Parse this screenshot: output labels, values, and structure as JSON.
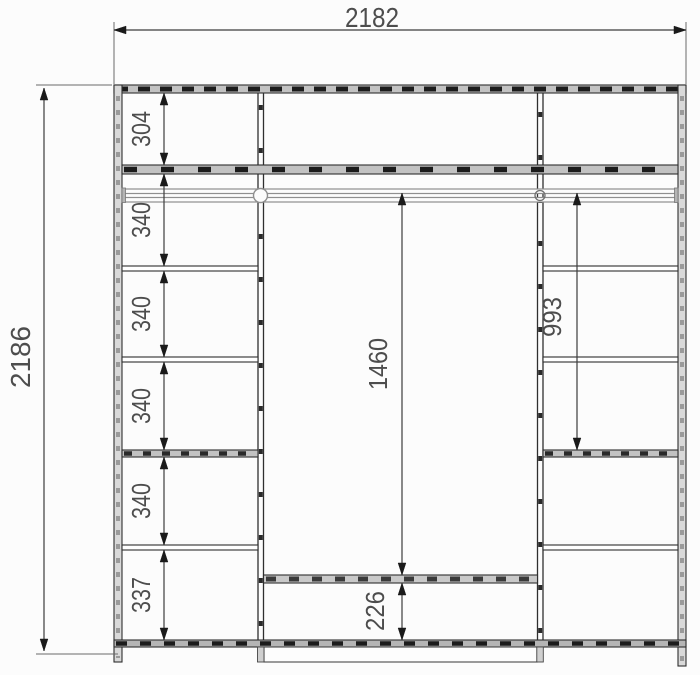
{
  "drawing": {
    "type": "wardrobe-elevation-dimension-drawing",
    "colors": {
      "background": "#fcfcfc",
      "main_line": "#2f2f2f",
      "dimension_line": "#3d3d3d",
      "extension_line": "#6a6a6a",
      "hatch_fill": "#c2c2c2",
      "hatch_dash": "#1c1c1c",
      "rod_gray": "#8f8f8f",
      "text": "#4d4d4d"
    },
    "dimensions": {
      "overall_width": "2182",
      "overall_height": "2186",
      "left_column_segments": [
        "304",
        "340",
        "340",
        "340",
        "340",
        "337"
      ],
      "center_opening_height": "1460",
      "center_bottom_height": "226",
      "right_opening_height": "993"
    }
  }
}
